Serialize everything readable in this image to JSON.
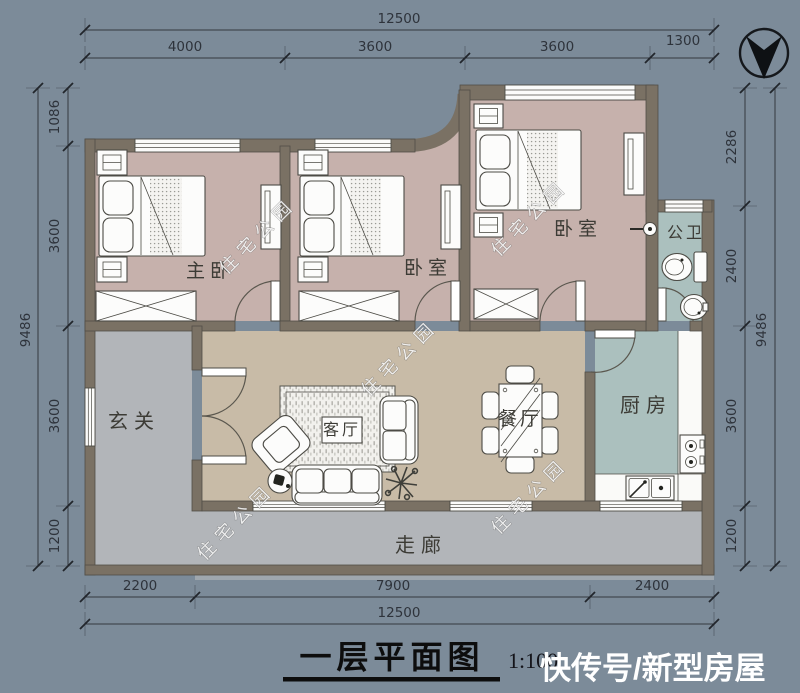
{
  "colors": {
    "background": "#7C8B99",
    "wall": "#7A7164",
    "bedroom_floor": "#C6B1AC",
    "living_floor": "#C8BBA7",
    "wet_floor": "#ABC0BE",
    "gray_floor": "#B2B5B9",
    "counter_white": "#FAFAF8"
  },
  "dimensions": {
    "top": {
      "total": "12500",
      "segments": [
        "4000",
        "3600",
        "3600",
        "1300"
      ]
    },
    "bottom": {
      "total": "12500",
      "segments": [
        "2200",
        "7900",
        "2400"
      ]
    },
    "left": {
      "total": "9486",
      "segments": [
        "1086",
        "3600",
        "3600",
        "1200"
      ]
    },
    "right": {
      "total": "9486",
      "segments": [
        "2286",
        "2400",
        "3600",
        "1200"
      ]
    }
  },
  "rooms": {
    "master_bedroom": "主卧",
    "bedroom_2": "卧室",
    "bedroom_3": "卧室",
    "bathroom": "公卫",
    "entry": "玄关",
    "living_room": "客厅",
    "dining_room": "餐厅",
    "kitchen": "厨房",
    "corridor": "走廊"
  },
  "title": {
    "text": "一层平面图",
    "scale": "1:100"
  },
  "watermarks": {
    "diagonal": "住宅公园",
    "brand": "快传号/新型房屋"
  }
}
